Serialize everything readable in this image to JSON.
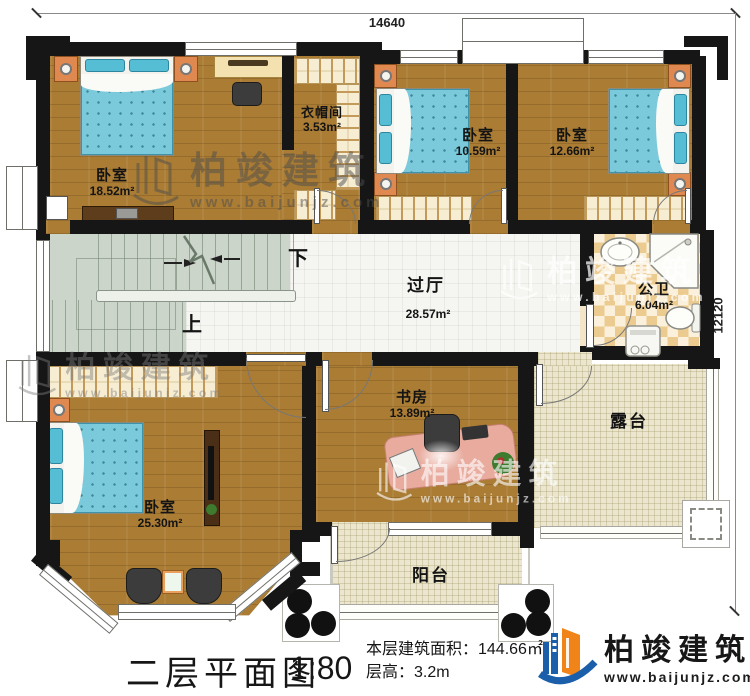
{
  "colors": {
    "wall": "#161616",
    "wood": "#aa7c34",
    "bed_blue": "#7bcadb",
    "stair_sage": "#cbd5ca",
    "tile_cream": "#ebe6cd",
    "checker_tan": "#eccb90",
    "brand_blue": "#1b5ea9",
    "brand_orange": "#f08419"
  },
  "dimensions": {
    "top": "14640",
    "right": "12120"
  },
  "rooms": {
    "bedroom_tl": {
      "name": "卧室",
      "area": "18.52m²"
    },
    "cloakroom": {
      "name": "衣帽间",
      "area": "3.53m²"
    },
    "bedroom_tm": {
      "name": "卧室",
      "area": "10.59m²"
    },
    "bedroom_tr": {
      "name": "卧室",
      "area": "12.66m²"
    },
    "hall": {
      "name": "过厅",
      "area": "28.57m²"
    },
    "bathroom": {
      "name": "公卫",
      "area": "6.04m²"
    },
    "bedroom_bl": {
      "name": "卧室",
      "area": "25.30m²"
    },
    "study": {
      "name": "书房",
      "area": "13.89m²"
    },
    "terrace": {
      "name": "露台"
    },
    "balcony": {
      "name": "阳台"
    }
  },
  "stairs": {
    "down_label": "下",
    "up_label": "上"
  },
  "title_block": {
    "plan_title": "二层平面图",
    "scale": "1:80",
    "area_line": "本层建筑面积：144.66㎡",
    "floor_height_line": "层高：3.2m"
  },
  "brand": {
    "name": "柏竣建筑",
    "url": "www.baijunjz.com"
  }
}
